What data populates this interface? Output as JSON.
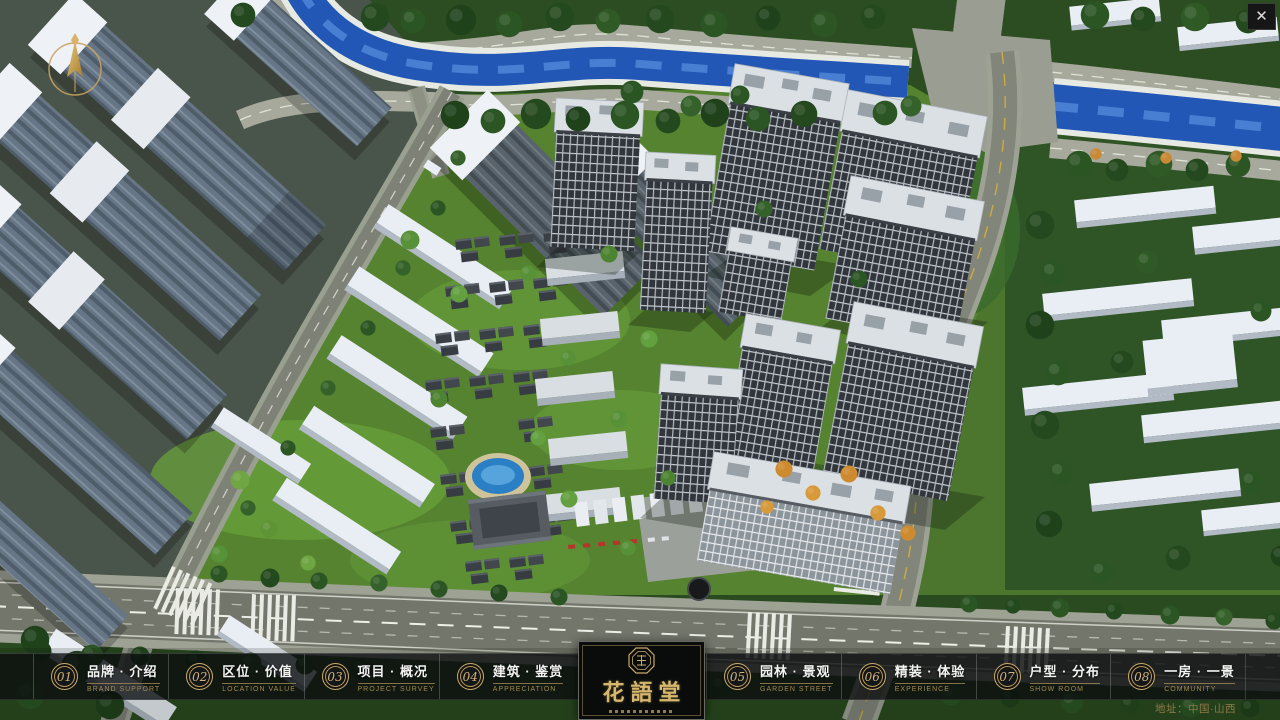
{
  "ui": {
    "close": "✕",
    "address": "地址：中国·山西",
    "logo": {
      "title": "花語堂"
    },
    "navbar": {
      "items": [
        {
          "num": "01",
          "title": "品牌 · 介绍",
          "subtitle": "BRAND SUPPORT"
        },
        {
          "num": "02",
          "title": "区位 · 价值",
          "subtitle": "LOCATION VALUE"
        },
        {
          "num": "03",
          "title": "项目 · 概况",
          "subtitle": "PROJECT SURVEY"
        },
        {
          "num": "04",
          "title": "建筑 · 鉴赏",
          "subtitle": "APPRECIATION"
        },
        {
          "num": "05",
          "title": "园林 · 景观",
          "subtitle": "GARDEN STREET"
        },
        {
          "num": "06",
          "title": "精装 · 体验",
          "subtitle": "EXPERIENCE"
        },
        {
          "num": "07",
          "title": "户型 · 分布",
          "subtitle": "SHOW ROOM"
        },
        {
          "num": "08",
          "title": "一房 · 一景",
          "subtitle": "COMMUNITY"
        }
      ]
    },
    "colors": {
      "gold_accent": "#c9ab6a",
      "bar_background": "rgba(10,13,14,0.78)",
      "river_blue": "#2257b5"
    }
  }
}
